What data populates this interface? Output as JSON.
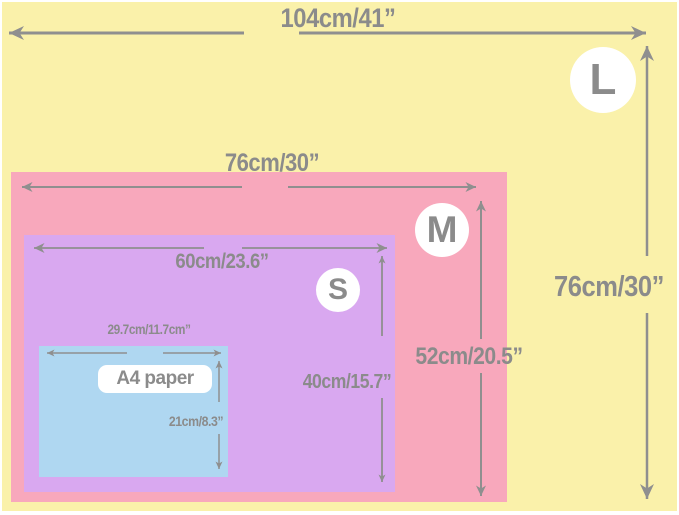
{
  "diagram": {
    "type": "size-comparison-chart",
    "colors": {
      "size_l_fill": "#faf1aa",
      "size_m_fill": "#f8a8bc",
      "size_s_fill": "#d9a8f0",
      "a4_fill": "#afd7f1",
      "annotation_gray": "#8b8b8b",
      "badge_fill": "#ffffff"
    },
    "sizes": {
      "large": {
        "badge": "L",
        "width_label": "104cm/41”",
        "height_label": "76cm/30”"
      },
      "medium": {
        "badge": "M",
        "width_label": "76cm/30”",
        "height_label": "52cm/20.5”"
      },
      "small": {
        "badge": "S",
        "width_label": "60cm/23.6”",
        "height_label": "40cm/15.7”"
      },
      "a4": {
        "name": "A4 paper",
        "width_label": "29.7cm/11.7cm”",
        "height_label": "21cm/8.3”"
      }
    }
  }
}
